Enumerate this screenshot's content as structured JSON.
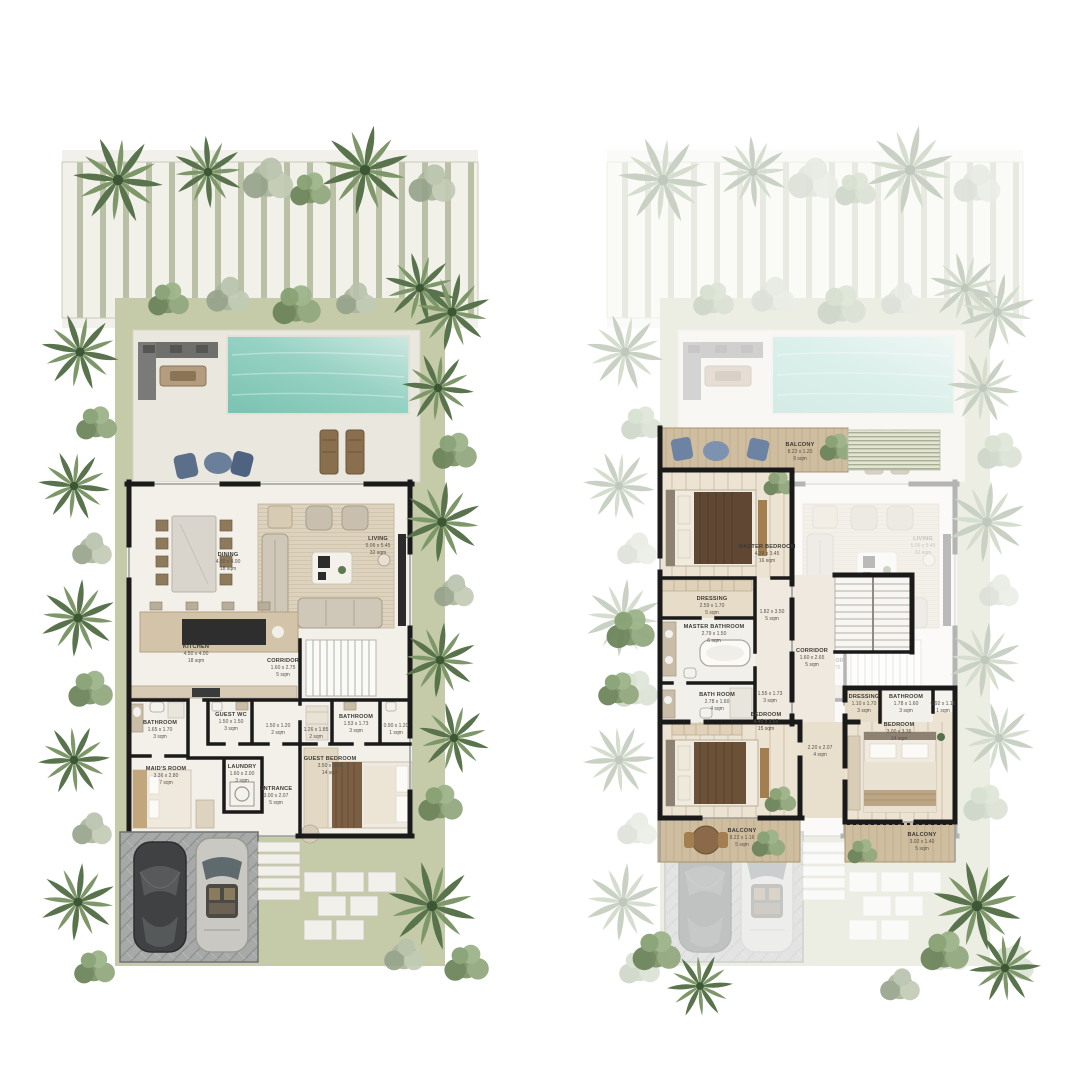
{
  "plans": {
    "ground": {
      "rooms": [
        {
          "name": "DINING",
          "dims": "4.50 x 4.00",
          "area": "18 sqm"
        },
        {
          "name": "LIVING",
          "dims": "5.06 x 5.45",
          "area": "32 sqm"
        },
        {
          "name": "KITCHEN",
          "dims": "4.50 x 4.00",
          "area": "18 sqm"
        },
        {
          "name": "CORRIDOR",
          "dims": "1.60 x 2.75",
          "area": "5 sqm"
        },
        {
          "name": "BATHROOM",
          "dims": "1.65 x 1.70",
          "area": "3 sqm"
        },
        {
          "name": "GUEST WC",
          "dims": "1.50 x 1.50",
          "area": "3 sqm"
        },
        {
          "name": "",
          "dims": "1.50 x 1.20",
          "area": "2 sqm"
        },
        {
          "name": "MAID'S ROOM",
          "dims": "3.36 x 2.80",
          "area": "7 sqm"
        },
        {
          "name": "LAUNDRY",
          "dims": "1.60 x 2.00",
          "area": "3 sqm"
        },
        {
          "name": "ENTRANCE",
          "dims": "3.00 x 2.07",
          "area": "5 sqm"
        },
        {
          "name": "",
          "dims": "1.26 x 1.85",
          "area": "2 sqm"
        },
        {
          "name": "BATHROOM",
          "dims": "1.53 x 1.73",
          "area": "3 sqm"
        },
        {
          "name": "",
          "dims": "0.90 x 1.20",
          "area": "1 sqm"
        },
        {
          "name": "GUEST BEDROOM",
          "dims": "3.50 x 3.55",
          "area": "14 sqm"
        }
      ]
    },
    "first": {
      "rooms": [
        {
          "name": "BALCONY",
          "dims": "8.22 x 1.20",
          "area": "9 sqm"
        },
        {
          "name": "MASTER BEDROOM",
          "dims": "4.38 x 3.45",
          "area": "16 sqm"
        },
        {
          "name": "DRESSING",
          "dims": "2.59 x 1.70",
          "area": "5 sqm"
        },
        {
          "name": "",
          "dims": "1.82 x 3.50",
          "area": "5 sqm"
        },
        {
          "name": "MASTER BATHROOM",
          "dims": "2.79 x 1.50",
          "area": "6 sqm"
        },
        {
          "name": "BATH ROOM",
          "dims": "2.78 x 1.60",
          "area": "4 sqm"
        },
        {
          "name": "",
          "dims": "1.55 x 1.73",
          "area": "3 sqm"
        },
        {
          "name": "CORRIDOR",
          "dims": "1.60 x 2.65",
          "area": "5 sqm"
        },
        {
          "name": "BEDROOM",
          "dims": "4.45 x 3.65",
          "area": "15 sqm"
        },
        {
          "name": "",
          "dims": "2.20 x 2.07",
          "area": "4 sqm"
        },
        {
          "name": "DRESSING",
          "dims": "1.10 x 1.70",
          "area": "3 sqm"
        },
        {
          "name": "BATHROOM",
          "dims": "1.78 x 1.60",
          "area": "3 sqm"
        },
        {
          "name": "",
          "dims": "0.92 x 1.16",
          "area": "1 sqm"
        },
        {
          "name": "BEDROOM",
          "dims": "3.00 x 3.36",
          "area": "14 sqm"
        },
        {
          "name": "BALCONY",
          "dims": "8.22 x 1.16",
          "area": "5 sqm"
        },
        {
          "name": "BALCONY",
          "dims": "3.02 x 1.40",
          "area": "5 sqm"
        }
      ]
    }
  },
  "colors": {
    "pool": "#8ecfc0",
    "grass": "#c5caa9",
    "stripe": "#b9c0a6",
    "wall": "#1a1a1a",
    "deck_wood": "#cfbda0",
    "sofa": "#cfc7b8",
    "duvet_dark": "#5f4734",
    "chair_blue": "#6d83a3",
    "palm_green": "#6c8759",
    "driveway": "#a6a9a7"
  }
}
